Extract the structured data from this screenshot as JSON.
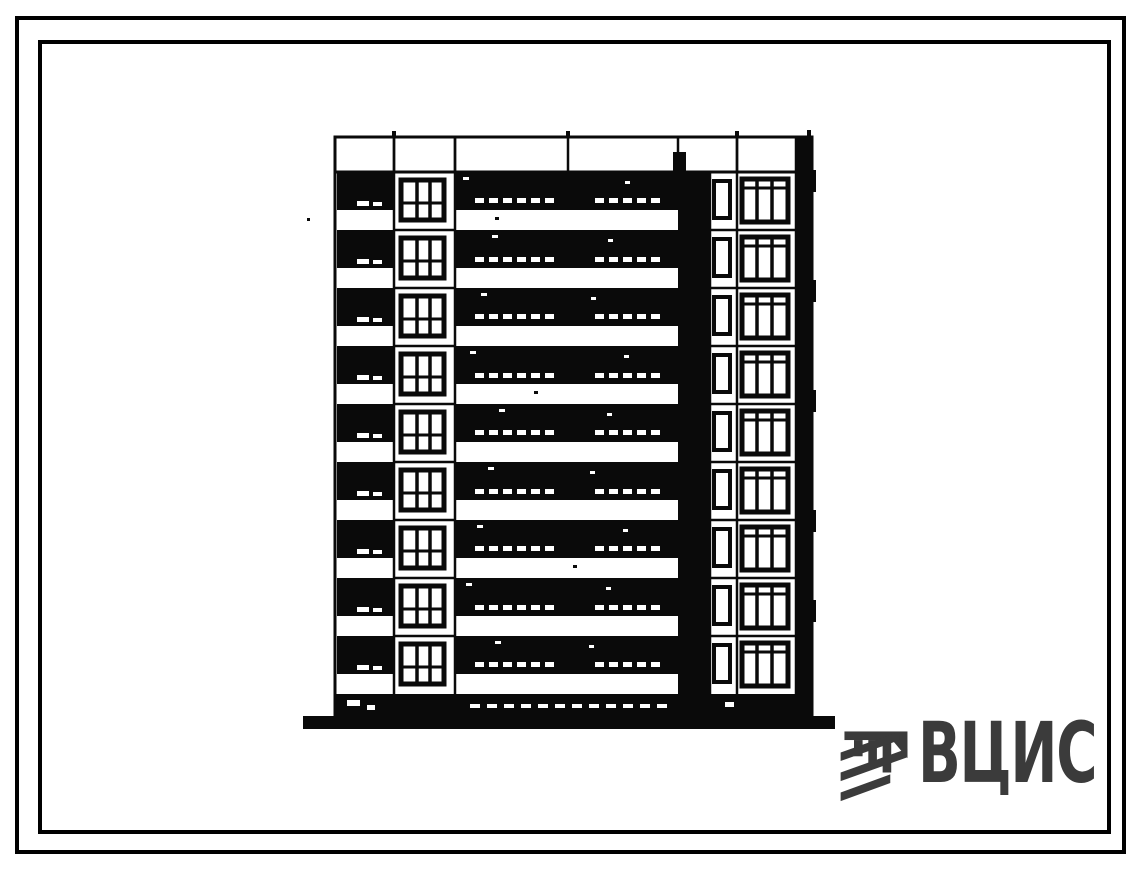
{
  "page": {
    "background": "#ffffff",
    "frame_color": "#000000"
  },
  "drawing": {
    "kind": "scanned-building-elevation",
    "ink_color": "#0a0a0a",
    "building": {
      "floors": 9,
      "sections": [
        "balcony-column-left",
        "window-bay-left",
        "balcony-loggia-center",
        "stair-shaft",
        "narrow-window-bay",
        "window-bay-right",
        "dark-edge-right"
      ]
    }
  },
  "logo": {
    "text": "ВЦИС",
    "color": "#3b3b3b",
    "icon": "vcis-emblem-icon"
  }
}
